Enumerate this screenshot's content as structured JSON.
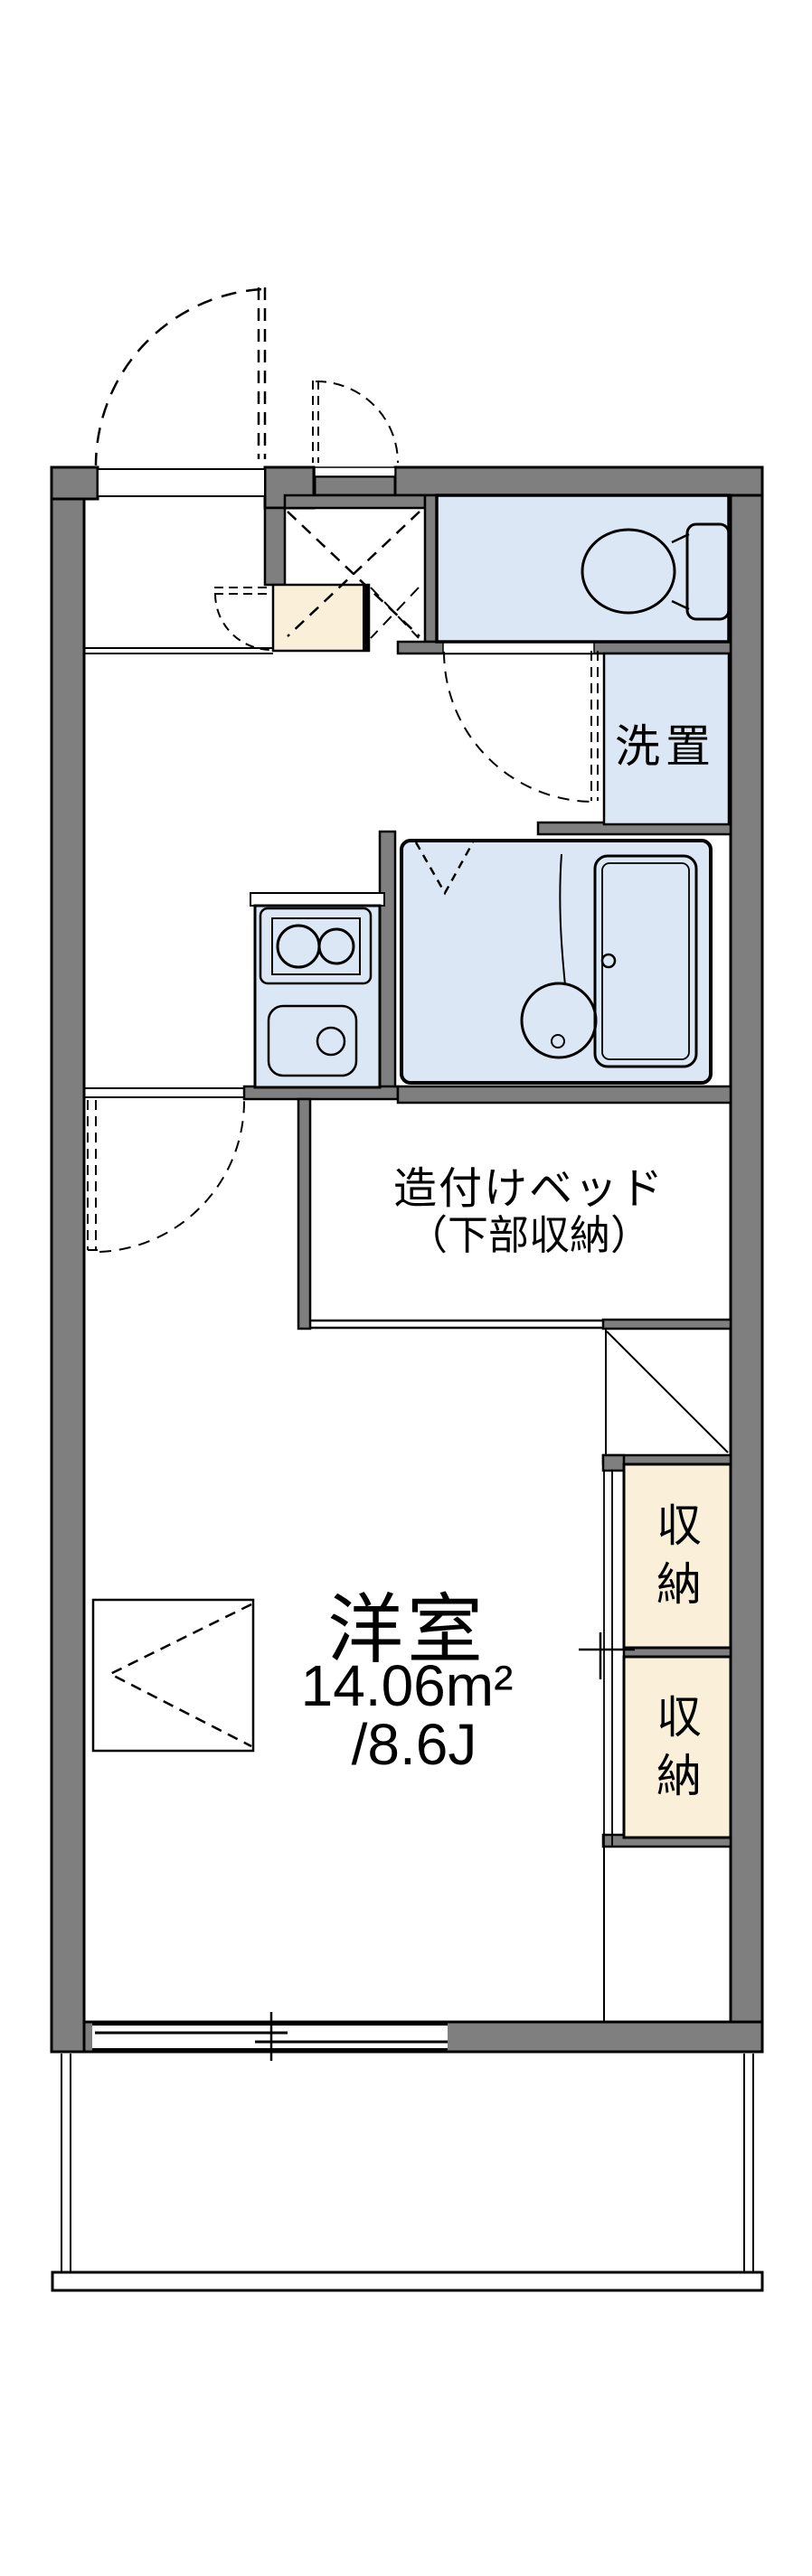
{
  "plan": {
    "rooms": {
      "laundry": {
        "label": "洗置"
      },
      "bed": {
        "line1": "造付けベッド",
        "line2": "（下部収納）"
      },
      "storage_upper": {
        "label": "収納"
      },
      "storage_lower": {
        "label": "収納"
      },
      "main_room": {
        "name": "洋室",
        "area_sqm": "14.06m²",
        "area_tatami": "/8.6J"
      }
    },
    "colors": {
      "wall": "#7f7f7f",
      "wet_area": "#dce7f6",
      "storage": "#faf0da",
      "line": "#000000",
      "background": "#ffffff"
    }
  }
}
